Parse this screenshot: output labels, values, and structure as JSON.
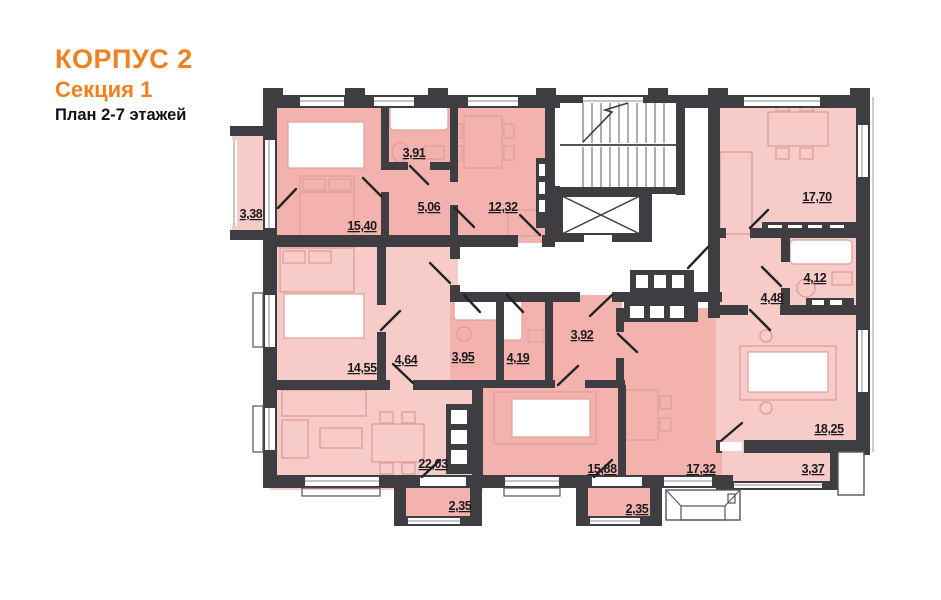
{
  "title": {
    "building": "КОРПУС 2",
    "section": "Секция 1",
    "floors": "План 2-7 этажей"
  },
  "colors": {
    "accent_orange": "#ef8122",
    "room_pink": "#f3b2ae",
    "room_pink_light": "#f7cbc7",
    "wall_dark": "#3e3e42",
    "furniture_line": "#e0a09c"
  },
  "rooms": [
    {
      "id": "balcony-3-38",
      "area": "3,38"
    },
    {
      "id": "bedroom-15-40",
      "area": "15,40"
    },
    {
      "id": "bathroom-3-91",
      "area": "3,91"
    },
    {
      "id": "hall-5-06",
      "area": "5,06"
    },
    {
      "id": "kitchen-12-32",
      "area": "12,32"
    },
    {
      "id": "living-kitchen-17-70",
      "area": "17,70"
    },
    {
      "id": "bathroom-4-12",
      "area": "4,12"
    },
    {
      "id": "hall-4-48",
      "area": "4,48"
    },
    {
      "id": "bedroom-14-55",
      "area": "14,55"
    },
    {
      "id": "hall-4-64",
      "area": "4,64"
    },
    {
      "id": "bathroom-3-95",
      "area": "3,95"
    },
    {
      "id": "bathroom-4-19",
      "area": "4,19"
    },
    {
      "id": "hall-3-92",
      "area": "3,92"
    },
    {
      "id": "living-kitchen-22-03",
      "area": "22,03"
    },
    {
      "id": "bedroom-15-88",
      "area": "15,88"
    },
    {
      "id": "living-kitchen-17-32",
      "area": "17,32"
    },
    {
      "id": "bedroom-18-25",
      "area": "18,25"
    },
    {
      "id": "balcony-3-37",
      "area": "3,37"
    },
    {
      "id": "balcony-2-35-left",
      "area": "2,35"
    },
    {
      "id": "balcony-2-35-right",
      "area": "2,35"
    }
  ]
}
